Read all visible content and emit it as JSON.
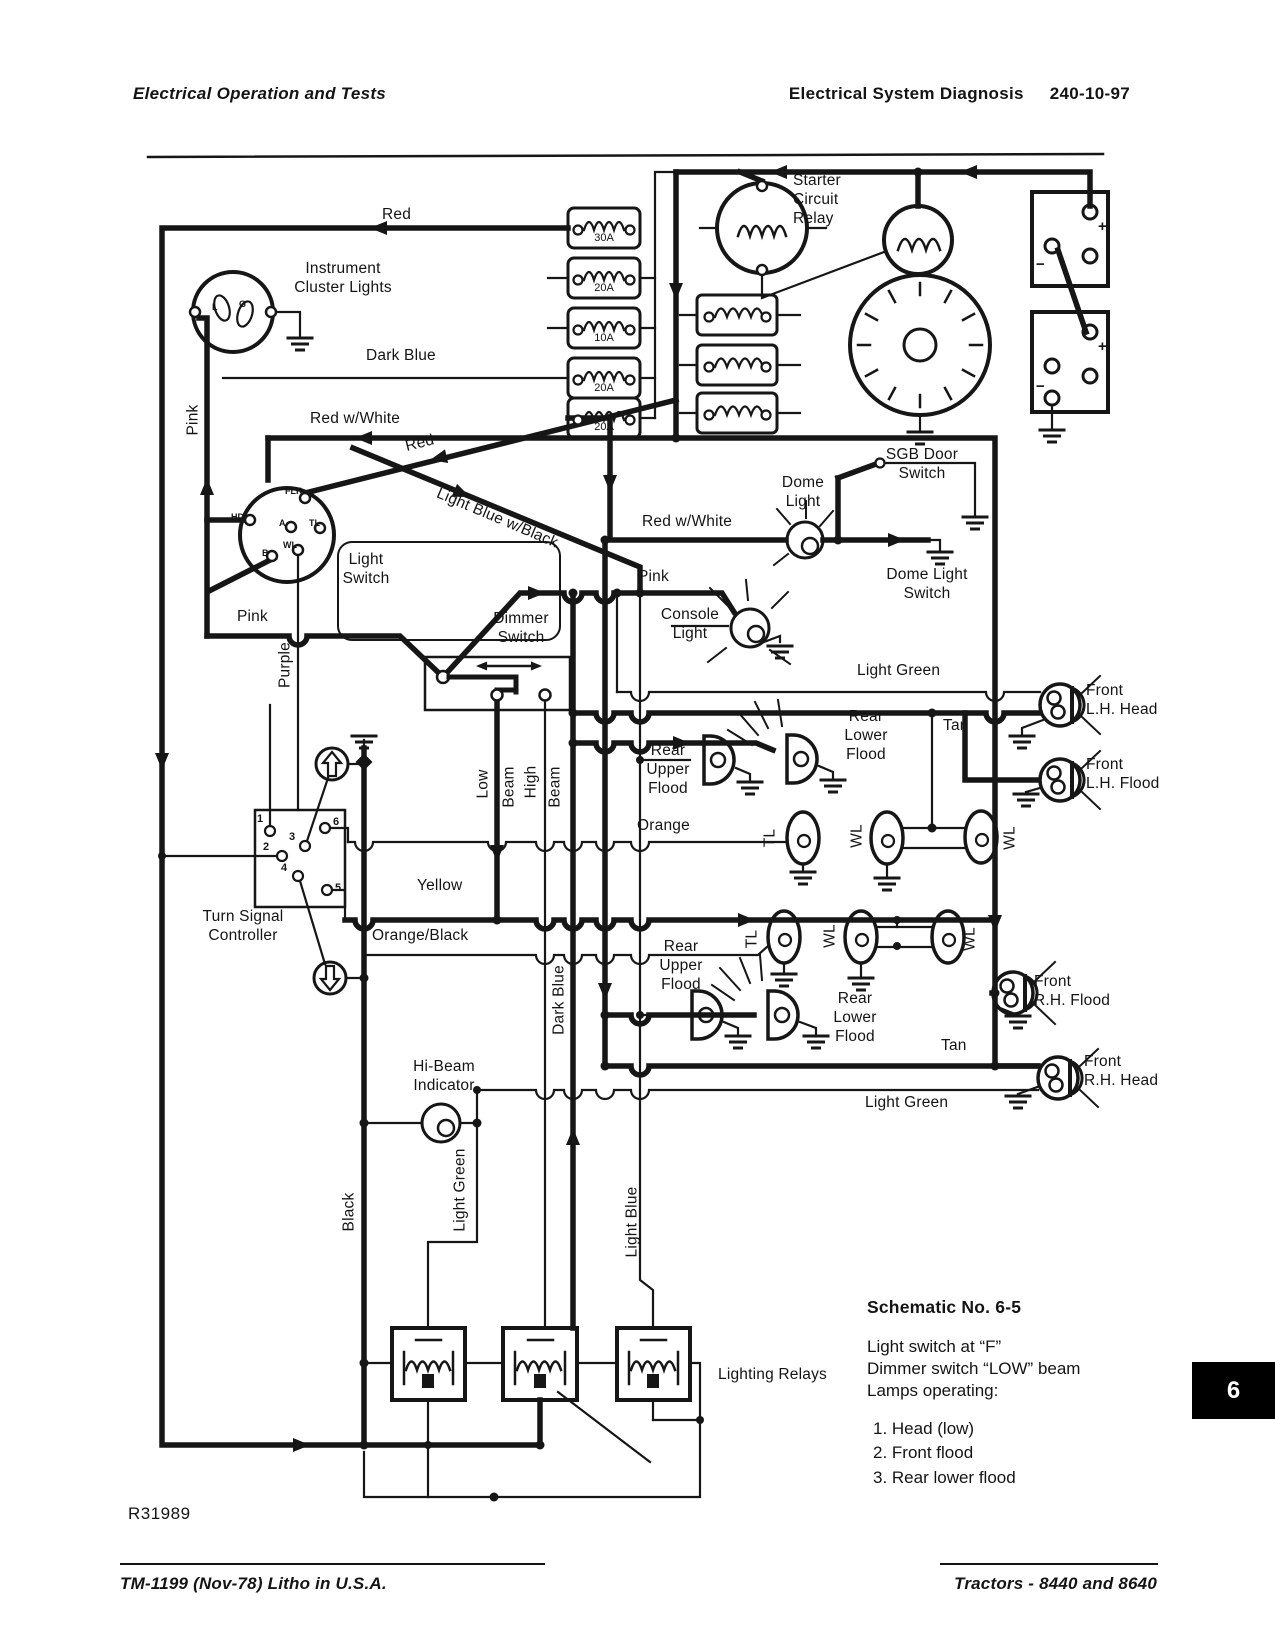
{
  "page": {
    "header_left": "Electrical Operation and Tests",
    "header_right_title": "Electrical System Diagnosis",
    "header_right_code": "240-10-97",
    "figure_ref": "R31989",
    "page_tab": "6",
    "footer_left": "TM-1199 (Nov-78) Litho in U.S.A.",
    "footer_right": "Tractors  -  8440 and 8640"
  },
  "notes": {
    "title": "Schematic No. 6-5",
    "body": "Light switch at “F”\nDimmer switch “LOW” beam\nLamps operating:",
    "items": [
      "1.  Head (low)",
      "2.  Front flood",
      "3.  Rear lower flood"
    ]
  },
  "labels": {
    "red_top": "Red",
    "instrument_cluster": "Instrument\nCluster Lights",
    "dark_blue": "Dark Blue",
    "red_w_white": "Red w/White",
    "red_diag": "Red",
    "light_blue_w_black": "Light Blue w/Black",
    "pink_vertical": "Pink",
    "pink": "Pink",
    "purple": "Purple",
    "light_switch": "Light\nSwitch",
    "dimmer_switch": "Dimmer\nSwitch",
    "console_light": "Console\nLight",
    "dome_light": "Dome\nLight",
    "sgb_door_switch": "SGB Door\nSwitch",
    "dome_light_switch": "Dome Light\nSwitch",
    "red_w_white_dome": "Red w/White",
    "pink_console": "Pink",
    "starter_circuit_relay": "Starter\nCircuit\nRelay",
    "light_green": "Light Green",
    "tan": "Tan",
    "front_lh_head": "Front\nL.H. Head",
    "front_lh_flood": "Front\nL.H. Flood",
    "rear_upper_flood": "Rear\nUpper\nFlood",
    "rear_lower_flood": "Rear\nLower\nFlood",
    "orange": "Orange",
    "yellow": "Yellow",
    "orange_black": "Orange/Black",
    "turn_signal_controller": "Turn Signal\nController",
    "front_rh_flood": "Front\nR.H. Flood",
    "front_rh_head": "Front\nR.H. Head",
    "tan2": "Tan",
    "light_green2": "Light Green",
    "hi_beam_indicator": "Hi-Beam\nIndicator",
    "low": "Low",
    "high": "High",
    "beam": "Beam",
    "dark_blue_vertical": "Dark Blue",
    "black_vertical": "Black",
    "light_green_vertical": "Light Green",
    "light_blue_vertical": "Light Blue",
    "lighting_relays": "Lighting Relays",
    "tl": "TL",
    "wl": "WL",
    "fuse_30a": "30A",
    "fuse_20a": "20A",
    "fuse_10a": "10A",
    "sw_hd": "HD",
    "sw_flr": "FLR",
    "sw_a": "A",
    "sw_tl": "TL",
    "sw_wl": "WL",
    "sw_b": "B",
    "cl_l": "L",
    "cl_g": "G",
    "t1": "1",
    "t2": "2",
    "t3": "3",
    "t4": "4",
    "t5": "5",
    "t6": "6",
    "plus": "+",
    "minus": "−"
  }
}
